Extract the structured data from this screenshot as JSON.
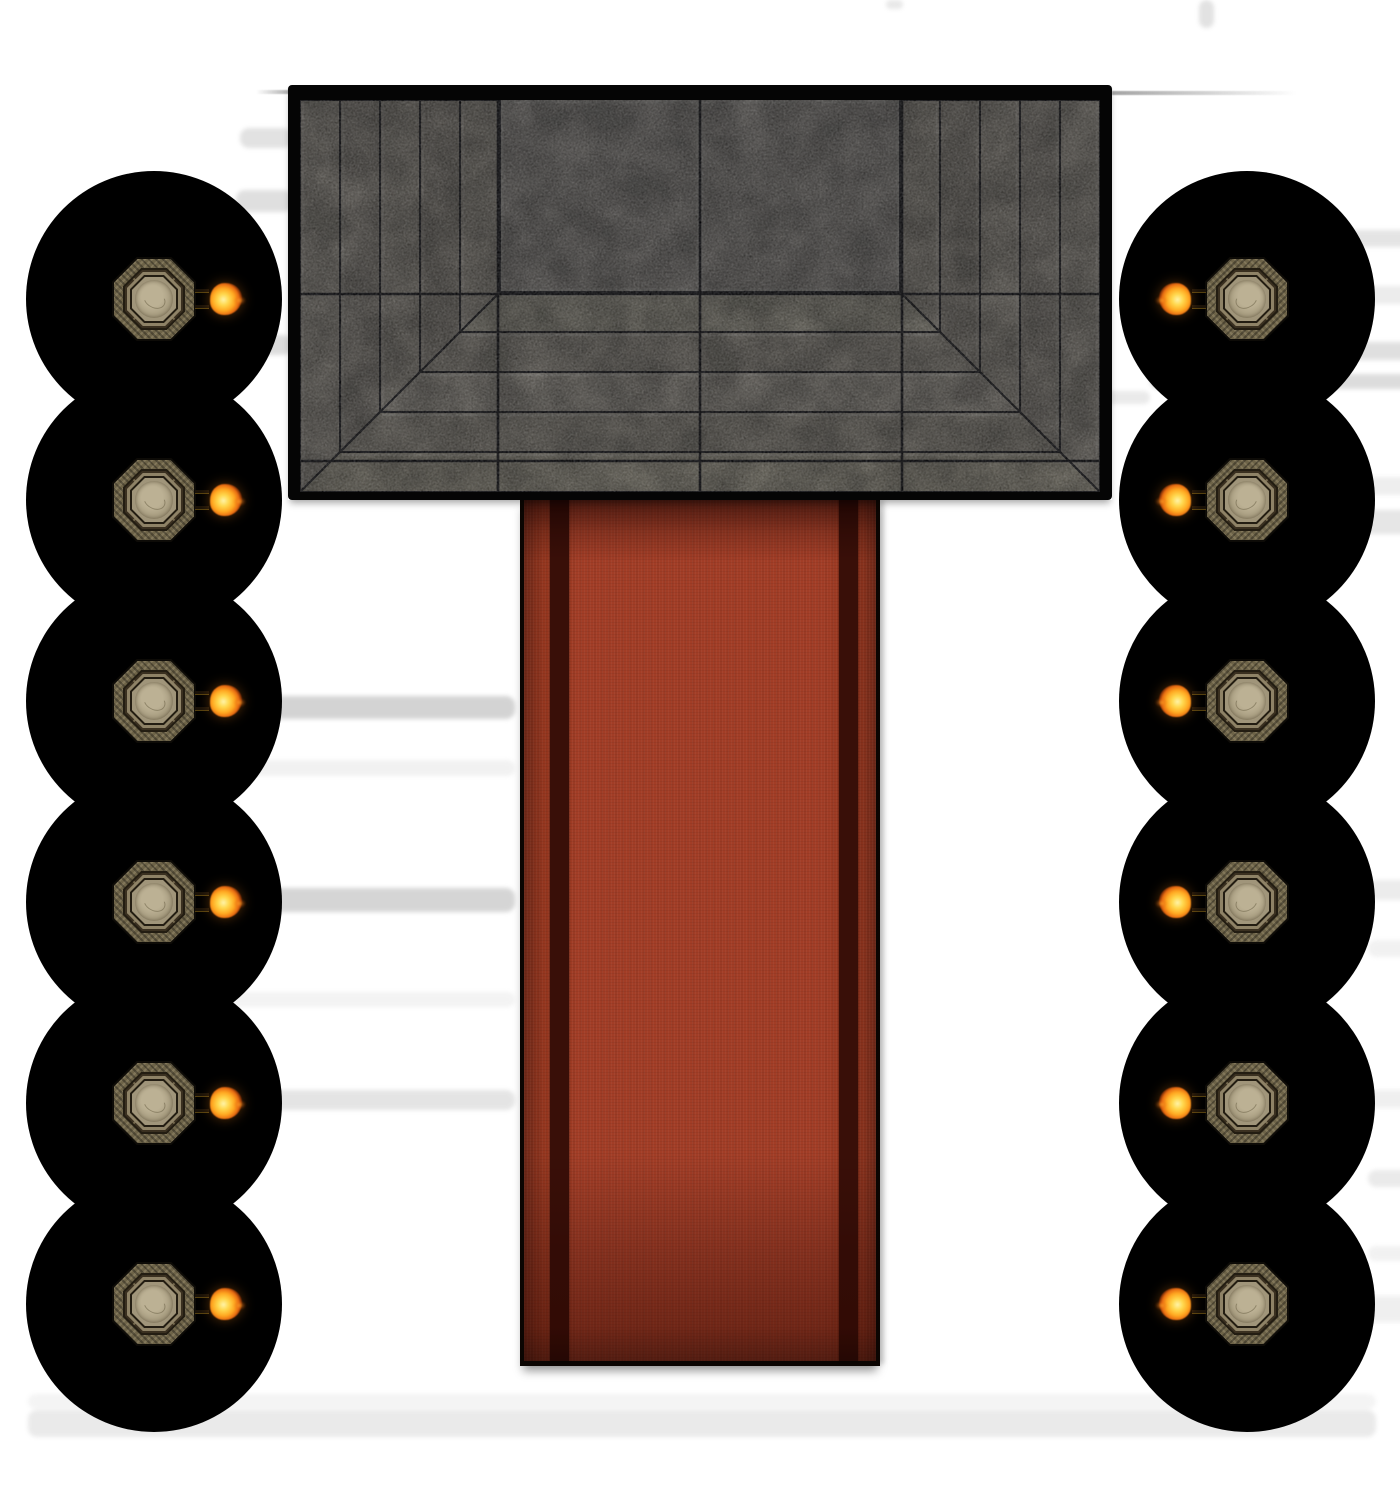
{
  "scene": {
    "type": "vtt-battle-map",
    "description": "top-down temple hall map: stepped stone dais, red carpet aisle, two columns of six torch-lit pillars in darkness blobs, faint bench shadows in white fog",
    "canvas": {
      "width": 1400,
      "height": 1500,
      "background": "#ffffff"
    }
  },
  "colors": {
    "fog_background": "#ffffff",
    "shadow_bar": "#989898",
    "wall_line": "#5a5a5a"
  },
  "dais": {
    "x": 288,
    "y": 85,
    "w": 824,
    "h": 415,
    "border": {
      "left": 12,
      "top": 15,
      "right": 12,
      "bottom": 8
    },
    "stone": {
      "w": 800,
      "h": 392
    },
    "steps": {
      "count": 5,
      "size": 40
    },
    "platform": {
      "x": 200,
      "w": 400,
      "h": 192
    },
    "grid": {
      "v": [
        198,
        400,
        602
      ],
      "h": [
        194,
        361
      ]
    },
    "shades": {
      "border": "#050505",
      "seam": "#101014",
      "grid_line": "#0a0a0e",
      "platform": "#666360",
      "side": [
        "#6f6b64",
        "#67635d",
        "#6d6962",
        "#64605a",
        "#6b6760"
      ],
      "bottom": [
        "#787468",
        "#6e6a62",
        "#75716a",
        "#6c6861",
        "#737066"
      ]
    }
  },
  "carpet": {
    "x": 520,
    "y": 498,
    "w": 360,
    "h": 868,
    "base": "#a23d26",
    "mid_edge": "#97371f",
    "edge": "#6e2818",
    "stripe_color": "#390f08",
    "stripes": [
      {
        "offset": 26,
        "width": 19
      },
      {
        "offset": 315,
        "width": 19
      }
    ]
  },
  "pillars": {
    "circle_radius": 128,
    "centers_y": [
      299,
      500,
      701,
      902,
      1103,
      1304
    ],
    "columns": [
      {
        "side": "left",
        "cx": 154,
        "flame_side": "right"
      },
      {
        "side": "right",
        "cx": 1247,
        "flame_side": "left"
      }
    ],
    "token_size": 84,
    "blob_color": "#000000",
    "pillar_palette": {
      "outline": "#0d0b07",
      "ring": "#6d6348",
      "seam": "#231d12",
      "corner": "#3a3020",
      "frame": "#8e8266",
      "face": "#a0957a",
      "core_light": "#bcb194",
      "core": "#a1967a"
    },
    "flame_palette": {
      "core": "#fff3a8",
      "bright": "#ffd84e",
      "mid": "#ffa821",
      "deep": "#e86d12",
      "ember": "#8c2305"
    }
  },
  "shadow_bars": [
    {
      "x": 886,
      "y": 0,
      "w": 17,
      "h": 9,
      "opacity": 0.22
    },
    {
      "x": 1199,
      "y": 0,
      "w": 15,
      "h": 28,
      "opacity": 0.28
    },
    {
      "x": 240,
      "y": 128,
      "w": 52,
      "h": 20,
      "opacity": 0.28
    },
    {
      "x": 236,
      "y": 190,
      "w": 56,
      "h": 22,
      "opacity": 0.3
    },
    {
      "x": 234,
      "y": 335,
      "w": 58,
      "h": 20,
      "opacity": 0.33
    },
    {
      "x": 140,
      "y": 696,
      "w": 375,
      "h": 23,
      "opacity": 0.42
    },
    {
      "x": 140,
      "y": 760,
      "w": 375,
      "h": 16,
      "opacity": 0.13
    },
    {
      "x": 140,
      "y": 888,
      "w": 375,
      "h": 24,
      "opacity": 0.4
    },
    {
      "x": 140,
      "y": 992,
      "w": 375,
      "h": 15,
      "opacity": 0.11
    },
    {
      "x": 140,
      "y": 1090,
      "w": 375,
      "h": 20,
      "opacity": 0.25
    },
    {
      "x": 1150,
      "y": 230,
      "w": 270,
      "h": 17,
      "opacity": 0.25
    },
    {
      "x": 1150,
      "y": 286,
      "w": 270,
      "h": 18,
      "opacity": 0.18
    },
    {
      "x": 1150,
      "y": 342,
      "w": 270,
      "h": 18,
      "opacity": 0.3
    },
    {
      "x": 1150,
      "y": 374,
      "w": 270,
      "h": 15,
      "opacity": 0.33
    },
    {
      "x": 1102,
      "y": 391,
      "w": 48,
      "h": 13,
      "opacity": 0.2
    },
    {
      "x": 1150,
      "y": 477,
      "w": 270,
      "h": 18,
      "opacity": 0.16
    },
    {
      "x": 1150,
      "y": 510,
      "w": 262,
      "h": 24,
      "opacity": 0.24
    },
    {
      "x": 1368,
      "y": 880,
      "w": 52,
      "h": 20,
      "opacity": 0.18
    },
    {
      "x": 1368,
      "y": 940,
      "w": 52,
      "h": 17,
      "opacity": 0.13
    },
    {
      "x": 1368,
      "y": 1090,
      "w": 52,
      "h": 18,
      "opacity": 0.15
    },
    {
      "x": 1368,
      "y": 1170,
      "w": 52,
      "h": 17,
      "opacity": 0.2
    },
    {
      "x": 1368,
      "y": 1246,
      "w": 52,
      "h": 15,
      "opacity": 0.13
    },
    {
      "x": 1360,
      "y": 1296,
      "w": 60,
      "h": 26,
      "opacity": 0.15
    },
    {
      "x": 28,
      "y": 1394,
      "w": 1348,
      "h": 15,
      "opacity": 0.1
    },
    {
      "x": 28,
      "y": 1410,
      "w": 1348,
      "h": 27,
      "opacity": 0.2
    }
  ],
  "wall_lines": [
    {
      "x": 288,
      "y": 88,
      "w": 824,
      "h": 3,
      "opacity": 0.4,
      "fade": "none"
    },
    {
      "x": 256,
      "y": 90,
      "w": 34,
      "h": 4,
      "opacity": 0.5,
      "fade": "left"
    },
    {
      "x": 1112,
      "y": 91,
      "w": 185,
      "h": 4,
      "opacity": 0.55,
      "fade": "right"
    }
  ]
}
